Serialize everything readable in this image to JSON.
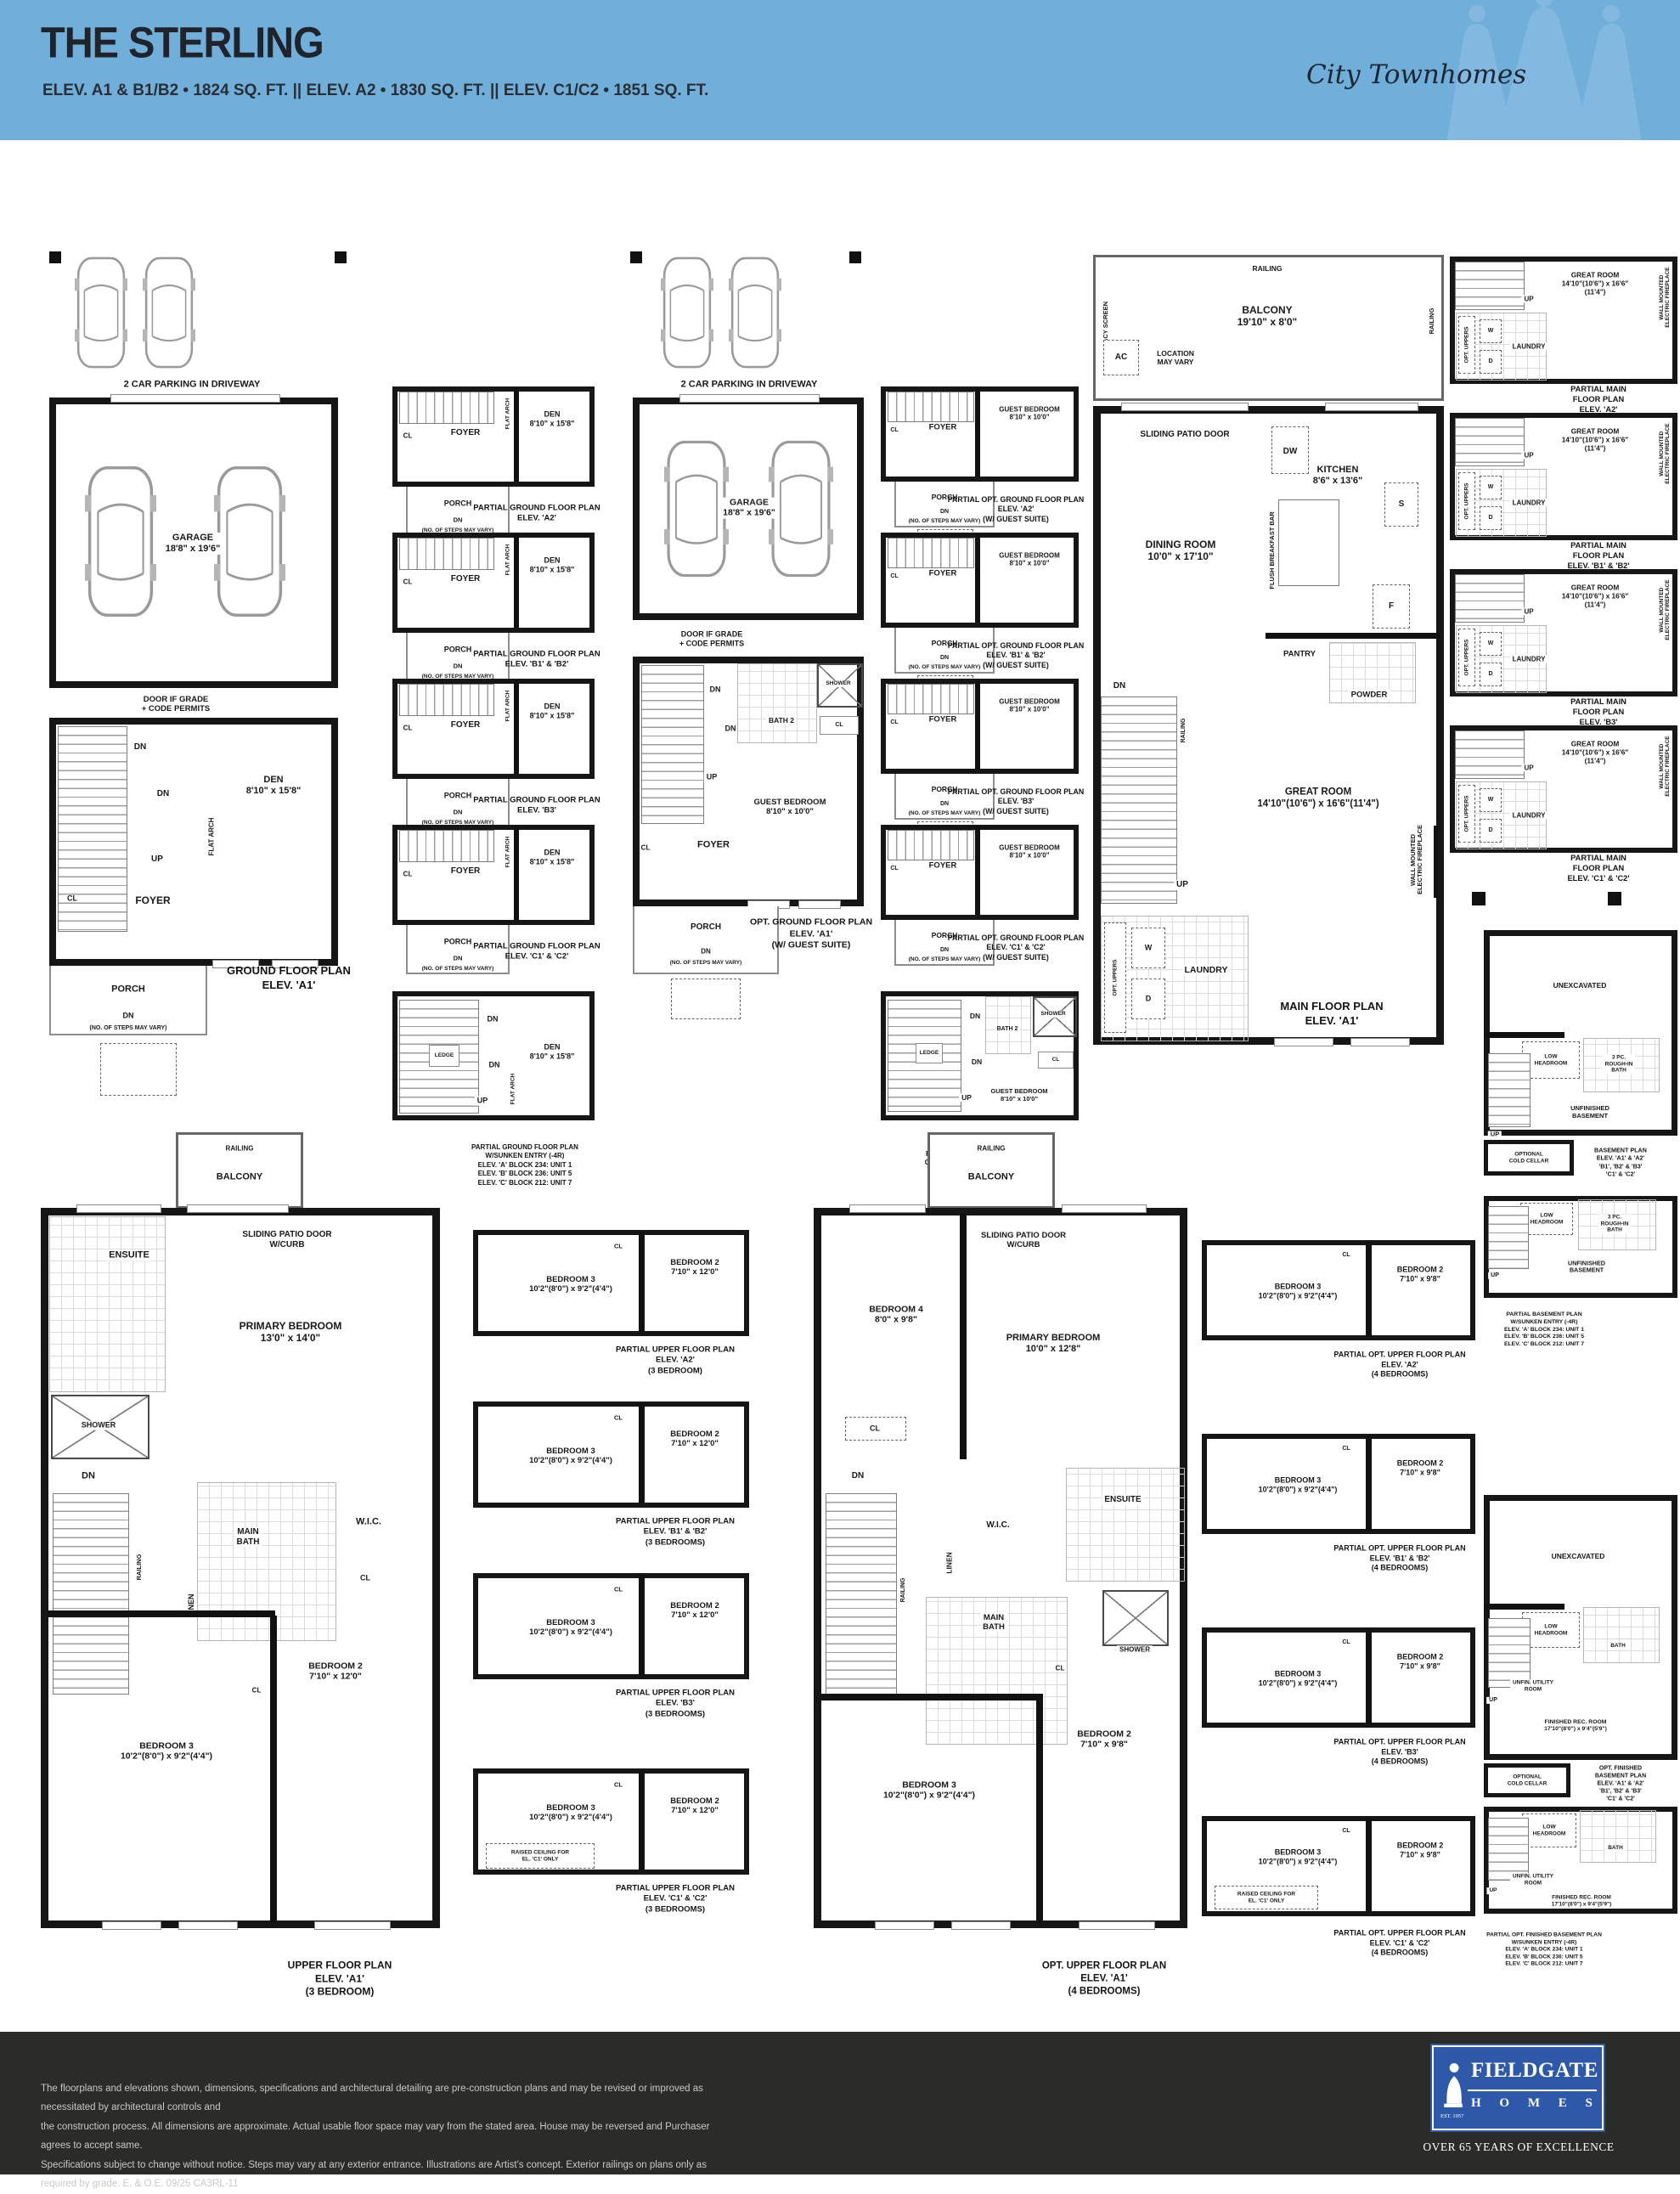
{
  "header": {
    "title": "THE STERLING",
    "subtitle": "ELEV. A1 & B1/B2 • 1824 SQ. FT.   ||   ELEV. A2 • 1830 SQ. FT.   ||   ELEV. C1/C2 • 1851 SQ. FT.",
    "brand": "City Townhomes",
    "bg_color": "#6fafda"
  },
  "c": {
    "park": "2 CAR PARKING IN DRIVEWAY",
    "gar": "GARAGE\n18'8\" x 19'6\"",
    "dg": "DOOR IF GRADE\n+ CODE PERMITS",
    "den": "DEN\n8'10\" x 15'8\"",
    "foyer": "FOYER",
    "cl": "CL",
    "up": "UP",
    "dn": "DN",
    "ledge": "LEDGE",
    "porch": "PORCH",
    "steps": "(NO. OF STEPS MAY VARY)",
    "fa": "FLAT ARCH",
    "guest": "GUEST BEDROOM\n8'10\" x 10'0\"",
    "bath2": "BATH 2",
    "shower": "SHOWER",
    "rail": "RAILING",
    "balc": "BALCONY\n19'10\" x 8'0\"",
    "balc_s": "BALCONY",
    "priv": "PRIVACY SCREEN",
    "ac": "AC",
    "loc": "LOCATION\nMAY VARY",
    "spd": "SLIDING PATIO DOOR",
    "spdc": "SLIDING PATIO DOOR\nW/CURB",
    "dw": "DW",
    "kit": "KITCHEN\n8'6\" x 13'6\"",
    "s": "S",
    "f": "F",
    "fbb": "FLUSH BREAKFAST BAR",
    "din": "DINING ROOM\n10'0\" x 17'10\"",
    "pan": "PANTRY",
    "pow": "POWDER",
    "great": "GREAT ROOM\n14'10\"(10'6\") x 16'6\"(11'4\")",
    "fire": "WALL MOUNTED\nELECTRIC FIREPLACE",
    "w": "W",
    "d": "D",
    "optu": "OPT. UPPERS",
    "lau": "LAUNDRY",
    "ens": "ENSUITE",
    "pri3": "PRIMARY BEDROOM\n13'0\" x 14'0\"",
    "pri4": "PRIMARY BEDROOM\n10'0\" x 12'8\"",
    "mb": "MAIN\nBATH",
    "wic": "W.I.C.",
    "lin": "LINEN",
    "b2a": "BEDROOM 2\n7'10\" x 12'0\"",
    "b2b": "BEDROOM 2\n7'10\" x 9'8\"",
    "b3": "BEDROOM 3\n10'2\"(8'0\") x 9'2\"(4'4\")",
    "b4": "BEDROOM 4\n8'0\" x 9'8\"",
    "rc": "RAISED CEILING FOR\nEL. 'C1' ONLY",
    "unex": "UNEXCAVATED",
    "lh": "LOW\nHEADROOM",
    "rib": "3 PC.\nROUGH-IN\nBATH",
    "ub": "UNFINISHED\nBASEMENT",
    "cc": "OPTIONAL\nCOLD CELLAR",
    "uur": "UNFIN. UTILITY\nROOM",
    "bath": "BATH",
    "rec": "FINISHED REC. ROOM\n17'10\"(8'0\") x 9'4\"(5'9\")"
  },
  "t": {
    "g_a1": "GROUND FLOOR PLAN\nELEV. 'A1'",
    "pg_a2": "PARTIAL GROUND FLOOR PLAN\nELEV. 'A2'",
    "pg_b12": "PARTIAL GROUND FLOOR PLAN\nELEV. 'B1' & 'B2'",
    "pg_b3": "PARTIAL GROUND FLOOR PLAN\nELEV. 'B3'",
    "pg_c12": "PARTIAL GROUND FLOOR PLAN\nELEV. 'C1' & 'C2'",
    "pg_sk": "PARTIAL GROUND FLOOR PLAN\nW/SUNKEN ENTRY (-4R)\nELEV. 'A' BLOCK 234: UNIT 1\nELEV. 'B' BLOCK 236: UNIT 5\nELEV. 'C' BLOCK 212: UNIT 7",
    "og_a1": "OPT. GROUND FLOOR PLAN\nELEV. 'A1'\n(W/ GUEST SUITE)",
    "pog_a2": "PARTIAL OPT. GROUND FLOOR PLAN\nELEV. 'A2'\n(W/ GUEST SUITE)",
    "pog_b12": "PARTIAL OPT. GROUND FLOOR PLAN\nELEV. 'B1' & 'B2'\n(W/ GUEST SUITE)",
    "pog_b3": "PARTIAL OPT. GROUND FLOOR PLAN\nELEV. 'B3'\n(W/ GUEST SUITE)",
    "pog_c12": "PARTIAL OPT. GROUND FLOOR PLAN\nELEV. 'C1' & 'C2'\n(W/ GUEST SUITE)",
    "pog_sk": "PARTIAL OPT. GROUND FLOOR PLAN\nGUEST SUITE W/SUNKEN ENTRY (-4R)\nELEV. 'A' BLOCK 234: UNIT 1\nELEV. 'B' BLOCK 236: UNIT 5\nELEV. 'C' BLOCK 212: UNIT 7",
    "m_a1": "MAIN FLOOR PLAN\nELEV. 'A1'",
    "pm_a2": "PARTIAL MAIN FLOOR PLAN\nELEV. 'A2'",
    "pm_b12": "PARTIAL MAIN FLOOR PLAN\nELEV. 'B1' & 'B2'",
    "pm_b3": "PARTIAL MAIN FLOOR PLAN\nELEV. 'B3'",
    "pm_c12": "PARTIAL MAIN FLOOR PLAN\nELEV. 'C1' & 'C2'",
    "bs": "BASEMENT PLAN\nELEV. 'A1' & 'A2'\n'B1', 'B2' & 'B3'\n'C1' & 'C2'",
    "pbs_sk": "PARTIAL BASEMENT PLAN\nW/SUNKEN ENTRY (-4R)\nELEV. 'A' BLOCK 234: UNIT 1\nELEV. 'B' BLOCK 236: UNIT 5\nELEV. 'C' BLOCK 212: UNIT 7",
    "fbs": "OPT. FINISHED BASEMENT PLAN\nELEV. 'A1' & 'A2'\n'B1', 'B2' & 'B3'\n'C1' & 'C2'",
    "pfbs_sk": "PARTIAL OPT. FINISHED BASEMENT PLAN\nW/SUNKEN ENTRY (-4R)\nELEV. 'A' BLOCK 234: UNIT 1\nELEV. 'B' BLOCK 236: UNIT 5\nELEV. 'C' BLOCK 212: UNIT 7",
    "u_a1": "UPPER FLOOR PLAN\nELEV. 'A1'\n(3 BEDROOM)",
    "pu_a2": "PARTIAL UPPER FLOOR PLAN\nELEV. 'A2'\n(3 BEDROOM)",
    "pu_b12": "PARTIAL UPPER FLOOR PLAN\nELEV. 'B1' & 'B2'\n(3 BEDROOMS)",
    "pu_b3": "PARTIAL UPPER FLOOR PLAN\nELEV. 'B3'\n(3 BEDROOMS)",
    "pu_c12": "PARTIAL UPPER FLOOR PLAN\nELEV. 'C1' & 'C2'\n(3 BEDROOMS)",
    "ou_a1": "OPT. UPPER FLOOR PLAN\nELEV. 'A1'\n(4 BEDROOMS)",
    "pou_a2": "PARTIAL OPT. UPPER FLOOR PLAN\nELEV. 'A2'\n(4 BEDROOMS)",
    "pou_b12": "PARTIAL OPT. UPPER FLOOR PLAN\nELEV. 'B1' & 'B2'\n(4 BEDROOMS)",
    "pou_b3": "PARTIAL OPT. UPPER FLOOR PLAN\nELEV. 'B3'\n(4 BEDROOMS)",
    "pou_c12": "PARTIAL OPT. UPPER FLOOR PLAN\nELEV. 'C1' & 'C2'\n(4 BEDROOMS)"
  },
  "footer": {
    "disclaimer": "The floorplans and elevations shown, dimensions, specifications and architectural detailing are pre-construction plans and may be revised or improved as necessitated by architectural controls and\nthe construction process. All dimensions are approximate. Actual usable floor space may vary from the stated area. House may be reversed and Purchaser agrees to accept same.\nSpecifications subject to change without notice. Steps may vary at any exterior entrance. Illustrations are Artist's concept. Exterior railings on plans only as required by grade. E. & O.E. 09/25  CA3RL-11",
    "logo_name": "FIELDGATE",
    "logo_sub": "H O M E S",
    "logo_est": "EST. 1957",
    "tagline": "OVER 65 YEARS OF EXCELLENCE",
    "logo_color": "#2d59a8"
  }
}
